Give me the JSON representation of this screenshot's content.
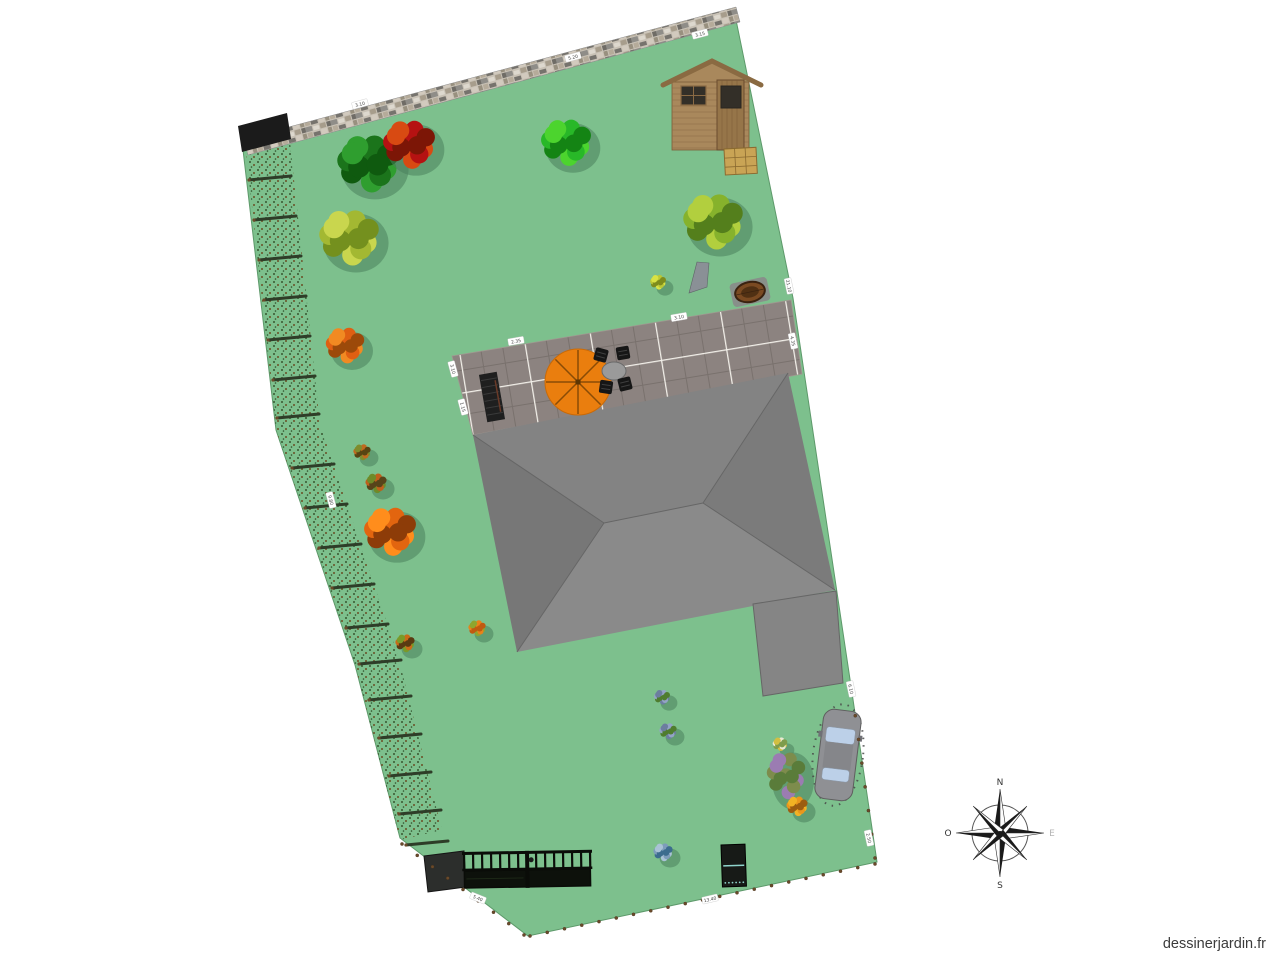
{
  "canvas": {
    "width": 1280,
    "height": 960
  },
  "watermark": {
    "text": "dessinerjardin.fr"
  },
  "lawn": {
    "fill": "#7dc08d",
    "stroke": "#5d996a",
    "points": "243,150 735,15 793,298 851,686 877,862 528,936 400,838 355,665 276,430"
  },
  "wall": {
    "points": "244,139 736,7 740,22 248,155",
    "endcap_points": "238,126 287,113 291,139 242,152",
    "endcap_fill": "#1b1b1b"
  },
  "hedge": {
    "band_points": "246,152 276,430 355,665 400,840 442,830 398,656 320,424 290,142",
    "log_color": "#2e3d28",
    "log_len": 42,
    "log_tip": "#6a4a2a",
    "logs": [
      [
        246,
        180
      ],
      [
        251,
        220
      ],
      [
        256,
        260
      ],
      [
        261,
        300
      ],
      [
        265,
        340
      ],
      [
        270,
        380
      ],
      [
        274,
        418
      ],
      [
        289,
        468
      ],
      [
        302,
        508
      ],
      [
        316,
        548
      ],
      [
        329,
        588
      ],
      [
        343,
        628
      ],
      [
        356,
        664
      ],
      [
        366,
        700
      ],
      [
        376,
        738
      ],
      [
        386,
        776
      ],
      [
        396,
        814
      ],
      [
        403,
        845
      ]
    ]
  },
  "terrace": {
    "points": "452,356 791,300 802,374 473,435"
  },
  "house": {
    "faces": [
      {
        "name": "roof-face-north",
        "points": "473,435 788,373 703,503 604,523",
        "fill": "#838383"
      },
      {
        "name": "roof-face-east",
        "points": "788,373 835,590 703,503",
        "fill": "#7b7b7b"
      },
      {
        "name": "roof-face-south",
        "points": "604,523 703,503 835,590 517,652",
        "fill": "#8a8a8a"
      },
      {
        "name": "roof-face-west",
        "points": "473,435 604,523 517,652",
        "fill": "#777777"
      }
    ],
    "ridges": [
      [
        473,
        435,
        604,
        523
      ],
      [
        788,
        373,
        703,
        503
      ],
      [
        604,
        523,
        703,
        503
      ],
      [
        835,
        590,
        703,
        503
      ],
      [
        517,
        652,
        604,
        523
      ]
    ],
    "extension": {
      "points": "753,604 836,591 843,683 763,696",
      "fill": "#858585"
    },
    "stroke": "#666666"
  },
  "shed": {
    "x": 672,
    "y": 82,
    "w": 77,
    "h": 68,
    "apex": [
      712,
      61
    ],
    "body_fill": "#a9885c",
    "roof_fill": "#8a6a42",
    "plank": "#8a6a44",
    "window_fill": "#332f28",
    "door_fill": "#967549",
    "crate": {
      "x": 724,
      "y": 149,
      "w": 32,
      "h": 26,
      "rot": -3,
      "fill": "#c9a455",
      "line": "#8a6a30"
    }
  },
  "furniture": {
    "parasol": {
      "cx": 578,
      "cy": 382,
      "r": 33,
      "fill": "#ea7e0e",
      "rib": "#8a4c06",
      "edge": "#c96a08"
    },
    "table": {
      "cx": 614,
      "cy": 371,
      "rx": 12,
      "ry": 9,
      "fill": "#9a9a9a",
      "edge": "#6a6a6a"
    },
    "chair_size": 13,
    "chair_fill": "#161616",
    "chairs": [
      {
        "cx": 601,
        "cy": 355,
        "rot": 15
      },
      {
        "cx": 623,
        "cy": 353,
        "rot": -10
      },
      {
        "cx": 606,
        "cy": 387,
        "rot": 8
      },
      {
        "cx": 625,
        "cy": 384,
        "rot": -14
      }
    ],
    "bench": {
      "cx": 492,
      "cy": 397,
      "w": 18,
      "h": 48,
      "rot": -10,
      "fill": "#1f1f1f",
      "slat": "#3a3a3a",
      "trim": "#6a3a28"
    },
    "lounge": {
      "points": "697,262 709,263 707,287 689,293",
      "fill": "#8a9096",
      "edge": "#5f6468"
    },
    "barrel": {
      "cx": 750,
      "cy": 292,
      "rot": -12,
      "fill": "#7a4a22",
      "inner": "#503013",
      "rim": "#3a2210",
      "base": "#8a8a8a"
    }
  },
  "car": {
    "cx": 838,
    "cy": 755,
    "rot": 7,
    "body": "#8f9094",
    "window": "#bcd0e8",
    "roof": "#85868a",
    "outline": "#5e5e5e",
    "speckle": "#474747"
  },
  "gate": {
    "x": 462,
    "y": 852,
    "w": 130,
    "h": 37,
    "rot": -1,
    "color": "#0a0c08",
    "panel": "#0d110b",
    "bars": 14
  },
  "wall_block": {
    "points": "424,856 464,851 466,887 428,892",
    "fill": "#2c2e2c",
    "edge": "#151515"
  },
  "composter": {
    "x": 721,
    "y": 845,
    "w": 24,
    "h": 42,
    "rot": -2,
    "fill": "#171a17",
    "line": "#8fd4cc"
  },
  "fence_posts": {
    "color": "#6b4a2a",
    "edge": "#3a2a18",
    "lines": [
      {
        "from": [
          402,
          844
        ],
        "to": [
          524,
          935
        ],
        "n": 9
      },
      {
        "from": [
          530,
          936
        ],
        "to": [
          875,
          864
        ],
        "n": 21
      },
      {
        "from": [
          852,
          692
        ],
        "to": [
          875,
          858
        ],
        "n": 8
      }
    ]
  },
  "trees": [
    {
      "name": "tree-dark-green",
      "cx": 368,
      "cy": 163,
      "r": 32,
      "colors": [
        "#1b741b",
        "#2f9e2f",
        "#0f5a0f"
      ]
    },
    {
      "name": "tree-red",
      "cx": 409,
      "cy": 144,
      "r": 27,
      "colors": [
        "#b51212",
        "#d84a12",
        "#7c1606"
      ]
    },
    {
      "name": "tree-bright-green",
      "cx": 566,
      "cy": 142,
      "r": 26,
      "colors": [
        "#28b828",
        "#4cd42e",
        "#148414"
      ]
    },
    {
      "name": "bush-yellow-green",
      "cx": 349,
      "cy": 237,
      "r": 31,
      "colors": [
        "#a3b832",
        "#c9d64e",
        "#74901e"
      ]
    },
    {
      "name": "tree-apple-green",
      "cx": 713,
      "cy": 221,
      "r": 31,
      "colors": [
        "#86b22c",
        "#b2cf3e",
        "#547f1c"
      ]
    },
    {
      "name": "bush-orange",
      "cx": 345,
      "cy": 345,
      "r": 20,
      "colors": [
        "#df5f12",
        "#f18a22",
        "#9c4a0a"
      ]
    },
    {
      "name": "tree-orange",
      "cx": 390,
      "cy": 531,
      "r": 27,
      "colors": [
        "#e2650f",
        "#ff8d1c",
        "#8d3c08"
      ]
    },
    {
      "name": "shrub-small-1",
      "cx": 362,
      "cy": 452,
      "r": 9,
      "colors": [
        "#bf6a1f",
        "#7f8c2c",
        "#574412"
      ]
    },
    {
      "name": "shrub-small-2",
      "cx": 376,
      "cy": 483,
      "r": 11,
      "colors": [
        "#bf5f1c",
        "#6f8a28",
        "#57441a"
      ]
    },
    {
      "name": "shrub-small-3",
      "cx": 405,
      "cy": 643,
      "r": 10,
      "colors": [
        "#c96a18",
        "#7a9a28",
        "#5a3a12"
      ]
    },
    {
      "name": "flower-orange-small",
      "cx": 477,
      "cy": 628,
      "r": 9,
      "colors": [
        "#e8821a",
        "#8fa52e",
        "#c05a10"
      ]
    },
    {
      "name": "plant-yellow-green",
      "cx": 658,
      "cy": 282,
      "r": 8,
      "colors": [
        "#bac736",
        "#d8e243",
        "#7e8c1c"
      ]
    },
    {
      "name": "flower-blue-1",
      "cx": 662,
      "cy": 697,
      "r": 8,
      "colors": [
        "#93a4c6",
        "#6c7e9f",
        "#4f7d2f"
      ]
    },
    {
      "name": "flower-blue-2",
      "cx": 668,
      "cy": 731,
      "r": 9,
      "colors": [
        "#93a4c6",
        "#6c7e9f",
        "#4f7d2f"
      ]
    },
    {
      "name": "plant-blue-gray",
      "cx": 663,
      "cy": 852,
      "r": 10,
      "colors": [
        "#7d9cba",
        "#a9c2d6",
        "#3c6c8e"
      ]
    },
    {
      "name": "flower-white",
      "cx": 780,
      "cy": 744,
      "r": 7,
      "colors": [
        "#e9e9d2",
        "#d2bf42",
        "#7e9c4c"
      ]
    },
    {
      "name": "lavender-bush",
      "cx": 786,
      "cy": 775,
      "r": 20,
      "sy": 1.5,
      "colors": [
        "#7d8c4c",
        "#9b7cb2",
        "#5a7c3a"
      ]
    },
    {
      "name": "flower-orange-2",
      "cx": 797,
      "cy": 806,
      "r": 11,
      "colors": [
        "#ea961c",
        "#f2b224",
        "#9c5c10"
      ]
    }
  ],
  "tree_shadow": {
    "fill": "#4b7f5c",
    "opacity": 0.55,
    "dx": 7,
    "dy": 6
  },
  "compass": {
    "cx": 1000,
    "cy": 833,
    "long": 44,
    "short": 38,
    "ring": 28,
    "labels": {
      "n": "N",
      "s": "S",
      "e": "E",
      "w": "O"
    },
    "label_color": "#333333",
    "east_color": "#b5b5b5",
    "dark": "#1a1a1a",
    "light": "#fdfdfd"
  },
  "dimension_labels": [
    {
      "x": 360,
      "y": 104,
      "rot": -15,
      "text": "3.10"
    },
    {
      "x": 573,
      "y": 57,
      "rot": -15,
      "text": "5.20"
    },
    {
      "x": 700,
      "y": 34,
      "rot": -15,
      "text": "3.15"
    },
    {
      "x": 789,
      "y": 286,
      "rot": 78,
      "text": "21.10"
    },
    {
      "x": 793,
      "y": 341,
      "rot": 78,
      "text": "4.35"
    },
    {
      "x": 851,
      "y": 689,
      "rot": 78,
      "text": "6.10"
    },
    {
      "x": 869,
      "y": 838,
      "rot": 78,
      "text": "2.50"
    },
    {
      "x": 478,
      "y": 898,
      "rot": 22,
      "text": "5.40"
    },
    {
      "x": 710,
      "y": 899,
      "rot": -13,
      "text": "13.40"
    },
    {
      "x": 331,
      "y": 500,
      "rot": 75,
      "text": "9.80"
    },
    {
      "x": 516,
      "y": 341,
      "rot": -10,
      "text": "2.35"
    },
    {
      "x": 679,
      "y": 317,
      "rot": -10,
      "text": "3.10"
    },
    {
      "x": 453,
      "y": 369,
      "rot": 75,
      "text": "3.10"
    },
    {
      "x": 463,
      "y": 407,
      "rot": 75,
      "text": "1.15"
    }
  ]
}
